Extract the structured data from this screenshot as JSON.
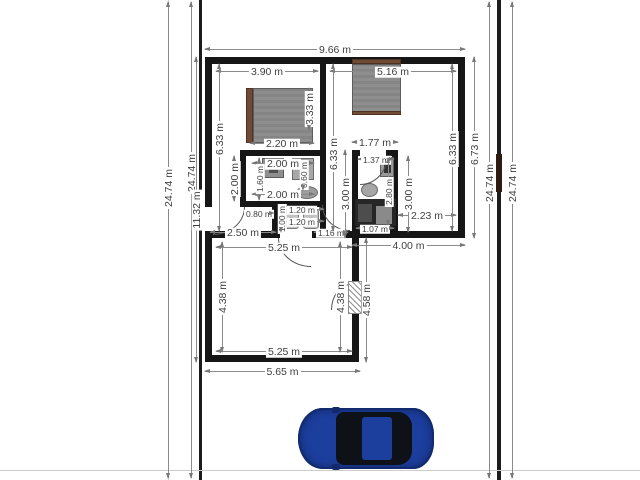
{
  "plan": {
    "title": "floor-plan",
    "unit": "m",
    "dims": {
      "building_width": "9.66 m",
      "bedroom_left_width": "3.90 m",
      "bedroom_right_width": "5.16 m",
      "bed_left_width": "2.20 m",
      "bed_left_height": "3.33 m",
      "bath_width_top": "2.00 m",
      "bath_width_bottom": "2.00 m",
      "bath_height": "2.00 m",
      "bath_inner_height": "1.60 m",
      "bath_fixture_width": "0.60 m",
      "wc_left": "0.80 m",
      "wc_top": "1.20 m",
      "wc_bottom": "1.20 m",
      "wc_height": "1.00 m",
      "hall_width": "2.50 m",
      "corridor_width": "1.16 m",
      "corridor_height": "3.00 m",
      "kitchen_width_outer": "1.77 m",
      "kitchen_width_inner": "1.37 m",
      "kitchen_height_inner": "2.80 m",
      "kitchen_bottom_width": "1.07 m",
      "right_room_height": "3.00 m",
      "right_gap": "2.23 m",
      "bottom_right_width": "4.00 m",
      "living_width_top": "5.25 m",
      "living_width_bottom": "5.25 m",
      "living_height_left": "4.38 m",
      "living_height_right": "4.38 m",
      "living_outer_height": "4.58 m",
      "living_outer_width": "5.65 m",
      "bedroom_left_height": "6.33 m",
      "center_height": "6.33 m",
      "right_height_inner": "6.33 m",
      "right_height_outer": "6.73 m",
      "building_depth": "11.32 m",
      "lot_left_outer": "24.74 m",
      "lot_left_inner": "24.74 m",
      "lot_right_inner": "24.74 m",
      "lot_right_outer": "24.74 m"
    },
    "colors": {
      "wall": "#161616",
      "dimension_line": "#8a8a8a",
      "dimension_text": "#3f3f3f",
      "bed": "#8c8c8c",
      "bed_trim": "#6f4b36",
      "counter": "#262626",
      "gate": "#2e1a10",
      "car_body": "#1c3e9d",
      "car_glass": "#0e1118"
    }
  }
}
